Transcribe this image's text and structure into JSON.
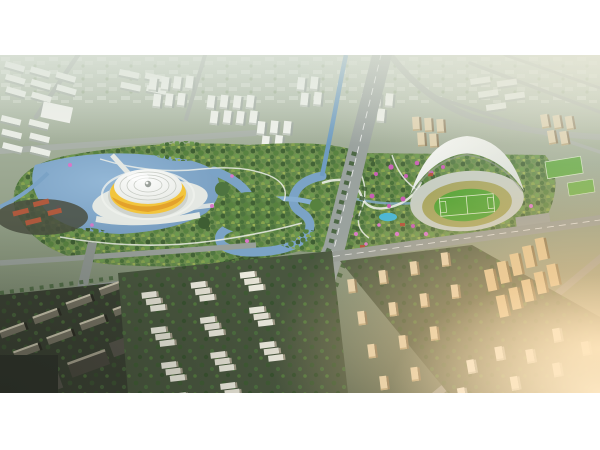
{
  "figure": {
    "alt": "Aerial CGI architectural rendering of an urban masterplan at late afternoon: a large central park with lakes, winding blue rivers and pink blossom patches; a round arena with a white dome and yellow band on a lakeside plaza at the left; a stadium with a white crescent shell roof, green pitch and running track at the right; a wide gray boulevard with a major intersection in the foreground; rows of white stepped apartment slabs, beige residential towers and clusters of white high-rise city blocks all around; warm golden sunlight haze entering from the right edge.",
    "scene": {
      "type": "architectural-aerial-rendering",
      "time_of_day": "late afternoon",
      "style": "photorealistic 3D masterplan visualization",
      "landmarks": [
        {
          "name": "saucer-arena",
          "description": "Round arena, white ribbed dome roof with yellow band, set on a white plaza surrounded by a lake"
        },
        {
          "name": "shell-stadium",
          "description": "Stadium with white crescent shell roof over a bright green pitch and tan running track"
        },
        {
          "name": "central-park",
          "description": "Dense green park with flowering pink trees, winding river, lakes and white footpaths"
        },
        {
          "name": "main-boulevard",
          "description": "Wide gray boulevard running from the foreground into the park, with a large road intersection"
        },
        {
          "name": "river-canal",
          "description": "Blue-green canal winding from the top of the image down into the park"
        },
        {
          "name": "residential-rows",
          "description": "Foreground rows of white stepped apartment slabs among trees"
        },
        {
          "name": "beige-tower-cluster",
          "description": "Dense cluster of warm beige residential towers at the lower right"
        },
        {
          "name": "dark-blocks",
          "description": "Shadowed dark building blocks in the lower left corner"
        },
        {
          "name": "city-towers",
          "description": "Clusters of white high-rise towers across the hazy upper city"
        },
        {
          "name": "sun-glow",
          "description": "Warm golden lens haze in the lower right corner"
        }
      ]
    },
    "palette": {
      "letterbox_white": "#ffffff",
      "haze": "#bcc7ba",
      "tree_green": "#567a42",
      "dark_forest": "#3c5531",
      "water_blue": "#7ba3c6",
      "road_gray": "#949b97",
      "building_white": "#edefe9",
      "arena_yellow": "#f2c53d",
      "pitch_green": "#58a837",
      "track_tan": "#a8a661",
      "blossom_pink": "#c85fb4",
      "beige_tower": "#e0cda6",
      "sun_warm": "#ffd39a"
    },
    "frame": {
      "margin_top_px": 55,
      "margin_bottom_px": 57,
      "image_width_px": 600,
      "image_height_px": 338
    }
  }
}
